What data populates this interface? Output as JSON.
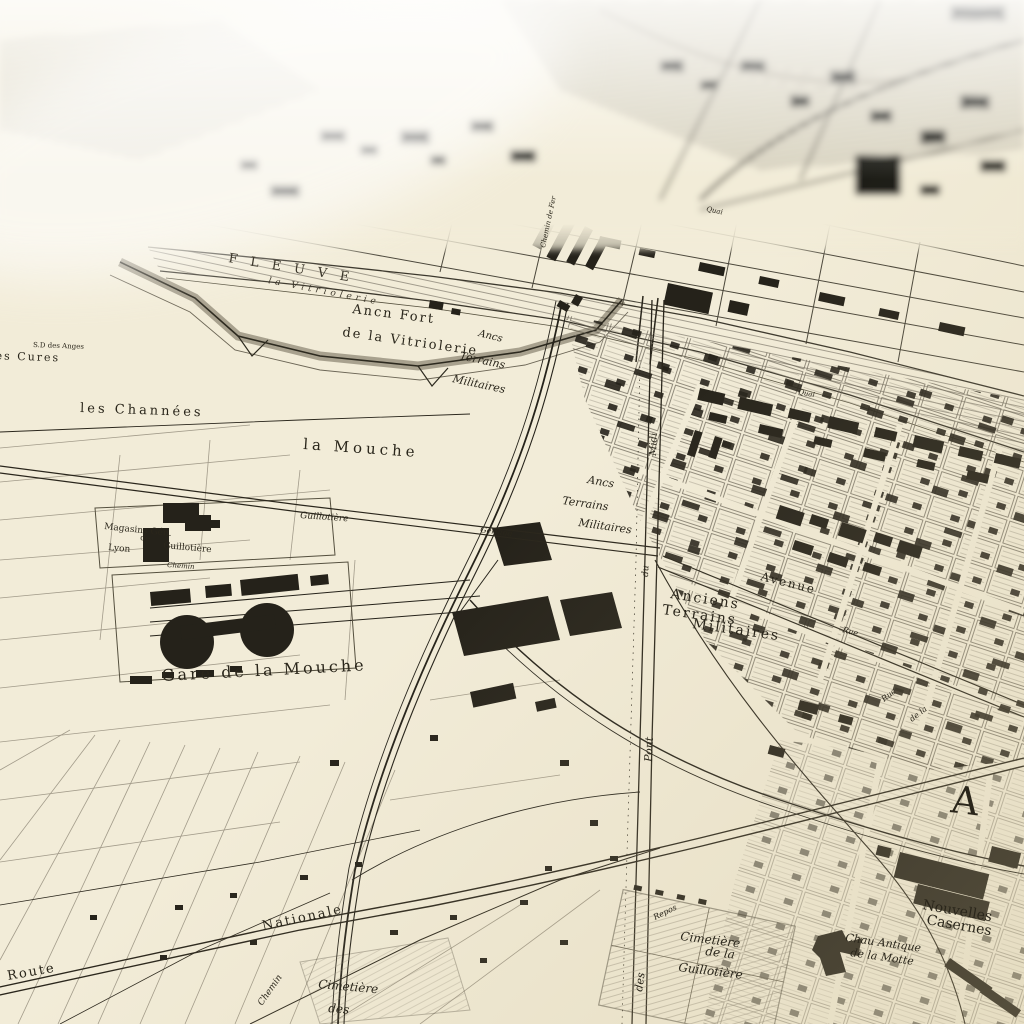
{
  "map": {
    "kind": "engraved-city-map-photo",
    "colors": {
      "paper": "#f2ecd8",
      "ink": "#25221a",
      "hatch": "#8d8779",
      "haze": "#fbfbf8"
    },
    "labels": {
      "fleuve": "FLEUVE",
      "vitriolerie_bank": "la Vitriolerie",
      "fort1": "Ancn Fort",
      "fort2": "de la Vitriolerie",
      "sd_anges": "S.D des Anges",
      "cures": "les Cures",
      "channees": "les Channées",
      "mouche": "la Mouche",
      "mag1": "Magasins Gén.",
      "mag2": "de",
      "mag3": "Lyon",
      "mag4": "Guillotière",
      "gare": "Gare de la Mouche",
      "t1a": "Ancs",
      "t1b": "Terrains",
      "t1c": "Militaires",
      "t2a": "Ancs",
      "t2b": "Terrains",
      "t2c": "Militaires",
      "t3a": "Anciens",
      "t3b": "Terrains",
      "t3c": "Militaires",
      "avenue": "Avenue",
      "quai1": "Quai",
      "quai2": "Quai",
      "chemin_fer": "Chemin de Fer",
      "midi": "Midi",
      "du1": "du",
      "pont": "Pont",
      "des": "des",
      "repos": "Repos",
      "rue1": "Rue",
      "rue2": "Rue",
      "dela": "de la",
      "gerland": "Gerland",
      "guillotiere_st": "Guillotière",
      "chemin1": "Chemin",
      "chemin2": "Chemin",
      "route": "Route",
      "nationale": "Nationale",
      "cg1": "Cimetière",
      "cg2": "de la",
      "cg3": "Guillotière",
      "motte1": "Chau Antique",
      "motte2": "de la Motte",
      "cas1": "Nouvelles",
      "cas2": "Casernes",
      "cd1": "Cimetière",
      "cd2": "des",
      "big_a": "A"
    }
  }
}
